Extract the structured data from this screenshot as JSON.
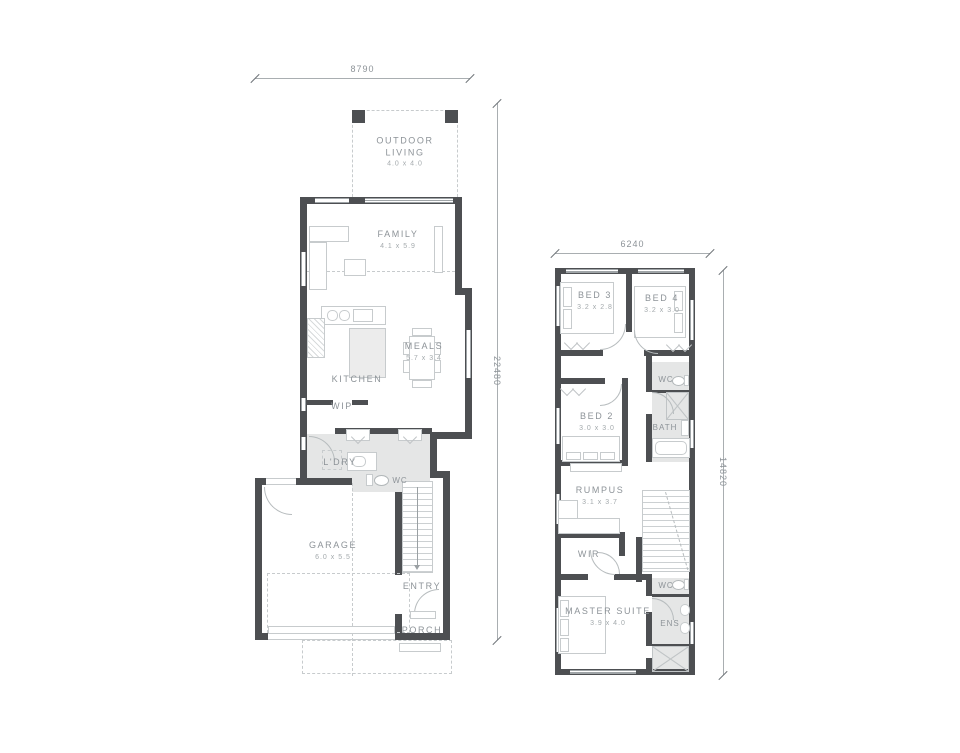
{
  "document": {
    "type": "architectural floor plan, two storeys"
  },
  "ground_floor": {
    "width_dim": "8790",
    "height_dim": "22480",
    "rooms": {
      "outdoor_living": {
        "name": "OUTDOOR LIVING",
        "size": "4.0 x 4.0"
      },
      "family": {
        "name": "FAMILY",
        "size": "4.1 x 5.9"
      },
      "meals": {
        "name": "MEALS",
        "size": "5.7 x 3.4"
      },
      "kitchen": {
        "name": "KITCHEN"
      },
      "wip": {
        "name": "WIP"
      },
      "ldry": {
        "name": "L'DRY"
      },
      "wc": {
        "name": "WC"
      },
      "garage": {
        "name": "GARAGE",
        "size": "6.0 x 5.5"
      },
      "entry": {
        "name": "ENTRY"
      },
      "porch": {
        "name": "PORCH"
      }
    }
  },
  "upper_floor": {
    "width_dim": "6240",
    "height_dim": "14820",
    "rooms": {
      "bed3": {
        "name": "BED 3",
        "size": "3.2 x 2.8"
      },
      "bed4": {
        "name": "BED 4",
        "size": "3.2 x 3.0"
      },
      "wc_upper": {
        "name": "WC"
      },
      "bath": {
        "name": "BATH"
      },
      "bed2": {
        "name": "BED 2",
        "size": "3.0 x 3.0"
      },
      "rumpus": {
        "name": "RUMPUS",
        "size": "3.1 x 3.7"
      },
      "wir": {
        "name": "WIR"
      },
      "wc_lower": {
        "name": "WC"
      },
      "master_suite": {
        "name": "MASTER SUITE",
        "size": "3.9 x 4.0"
      },
      "ens": {
        "name": "ENS"
      }
    }
  },
  "colors": {
    "wall": "#4d4f52",
    "label_text": "#8d9398",
    "wet_area": "#e5e6e6",
    "furniture_line": "#c7cbcd",
    "dimension_line": "#a9aeb1"
  }
}
